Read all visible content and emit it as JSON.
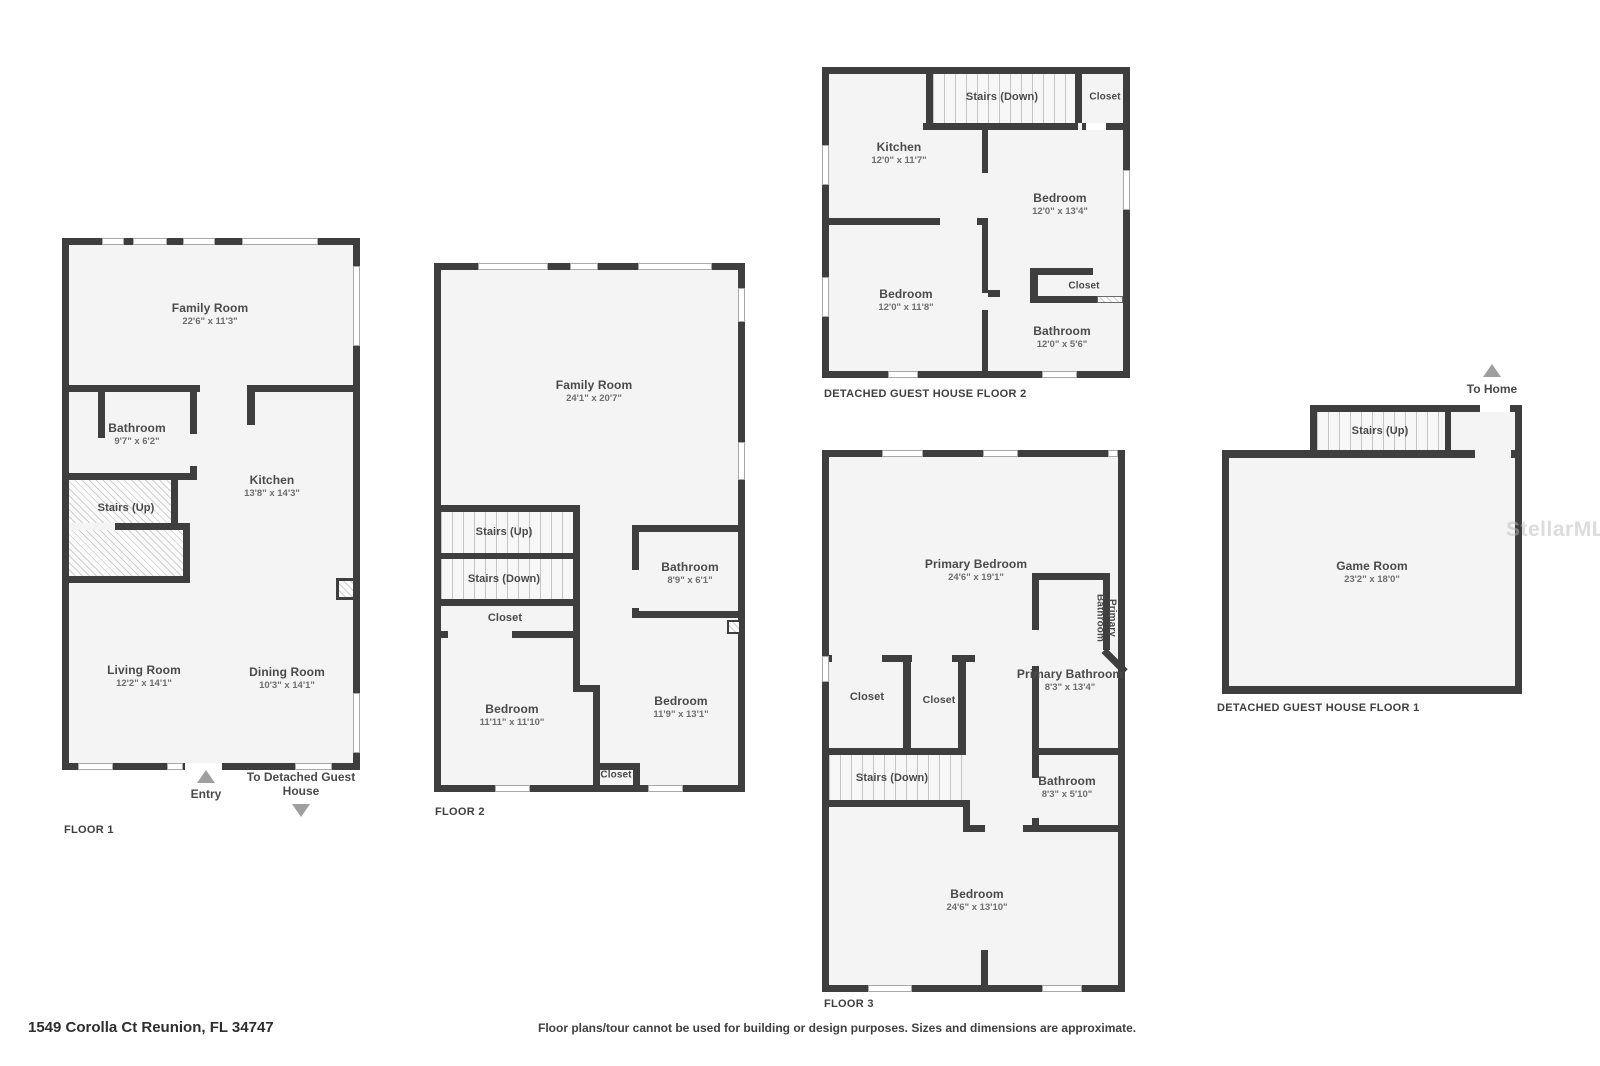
{
  "page": {
    "address": "1549 Corolla Ct Reunion, FL 34747",
    "disclaimer": "Floor plans/tour cannot be used for building or design purposes. Sizes and dimensions are approximate.",
    "watermark": "StellarMLS",
    "colors": {
      "wall": "#3e3e3e",
      "floor": "#f4f4f4",
      "label": "#4a4a4a",
      "arrow": "#9f9f9f"
    }
  },
  "plans": {
    "floor1": {
      "title": "FLOOR 1",
      "entry_label": "Entry",
      "guest_house_label": "To Detached Guest House",
      "rooms": {
        "family": {
          "name": "Family Room",
          "dims": "22'6\" x 11'3\""
        },
        "bathroom": {
          "name": "Bathroom",
          "dims": "9'7\" x 6'2\""
        },
        "kitchen": {
          "name": "Kitchen",
          "dims": "13'8\" x 14'3\""
        },
        "stairs_up": {
          "name": "Stairs (Up)"
        },
        "living": {
          "name": "Living Room",
          "dims": "12'2\" x 14'1\""
        },
        "dining": {
          "name": "Dining Room",
          "dims": "10'3\" x 14'1\""
        }
      }
    },
    "floor2": {
      "title": "FLOOR 2",
      "rooms": {
        "family": {
          "name": "Family Room",
          "dims": "24'1\" x 20'7\""
        },
        "stairs_up": {
          "name": "Stairs (Up)"
        },
        "stairs_down": {
          "name": "Stairs (Down)"
        },
        "closet": {
          "name": "Closet"
        },
        "bathroom": {
          "name": "Bathroom",
          "dims": "8'9\" x 6'1\""
        },
        "bedroom_left": {
          "name": "Bedroom",
          "dims": "11'11\" x 11'10\""
        },
        "bedroom_right": {
          "name": "Bedroom",
          "dims": "11'9\" x 13'1\""
        },
        "closet_lower": {
          "name": "Closet"
        }
      }
    },
    "floor3": {
      "title": "FLOOR 3",
      "rooms": {
        "primary_bedroom": {
          "name": "Primary Bedroom",
          "dims": "24'6\" x 19'1\""
        },
        "primary_bath_wc": {
          "name": "Primary Bathroom"
        },
        "primary_bath": {
          "name": "Primary Bathroom",
          "dims": "8'3\" x 13'4\""
        },
        "closet_left": {
          "name": "Closet"
        },
        "closet_mid": {
          "name": "Closet"
        },
        "stairs_down": {
          "name": "Stairs (Down)"
        },
        "bathroom": {
          "name": "Bathroom",
          "dims": "8'3\" x 5'10\""
        },
        "bedroom": {
          "name": "Bedroom",
          "dims": "24'6\" x 13'10\""
        }
      }
    },
    "guest_floor2": {
      "title": "DETACHED GUEST HOUSE FLOOR 2",
      "rooms": {
        "stairs_down": {
          "name": "Stairs (Down)"
        },
        "closet_top": {
          "name": "Closet"
        },
        "kitchen": {
          "name": "Kitchen",
          "dims": "12'0\" x 11'7\""
        },
        "bedroom_right": {
          "name": "Bedroom",
          "dims": "12'0\" x 13'4\""
        },
        "bedroom_left": {
          "name": "Bedroom",
          "dims": "12'0\" x 11'8\""
        },
        "closet_mid": {
          "name": "Closet"
        },
        "bathroom": {
          "name": "Bathroom",
          "dims": "12'0\" x 5'6\""
        }
      }
    },
    "guest_floor1": {
      "title": "DETACHED GUEST HOUSE FLOOR 1",
      "to_home_label": "To Home",
      "rooms": {
        "stairs_up": {
          "name": "Stairs (Up)"
        },
        "game_room": {
          "name": "Game Room",
          "dims": "23'2\" x 18'0\""
        }
      }
    }
  }
}
